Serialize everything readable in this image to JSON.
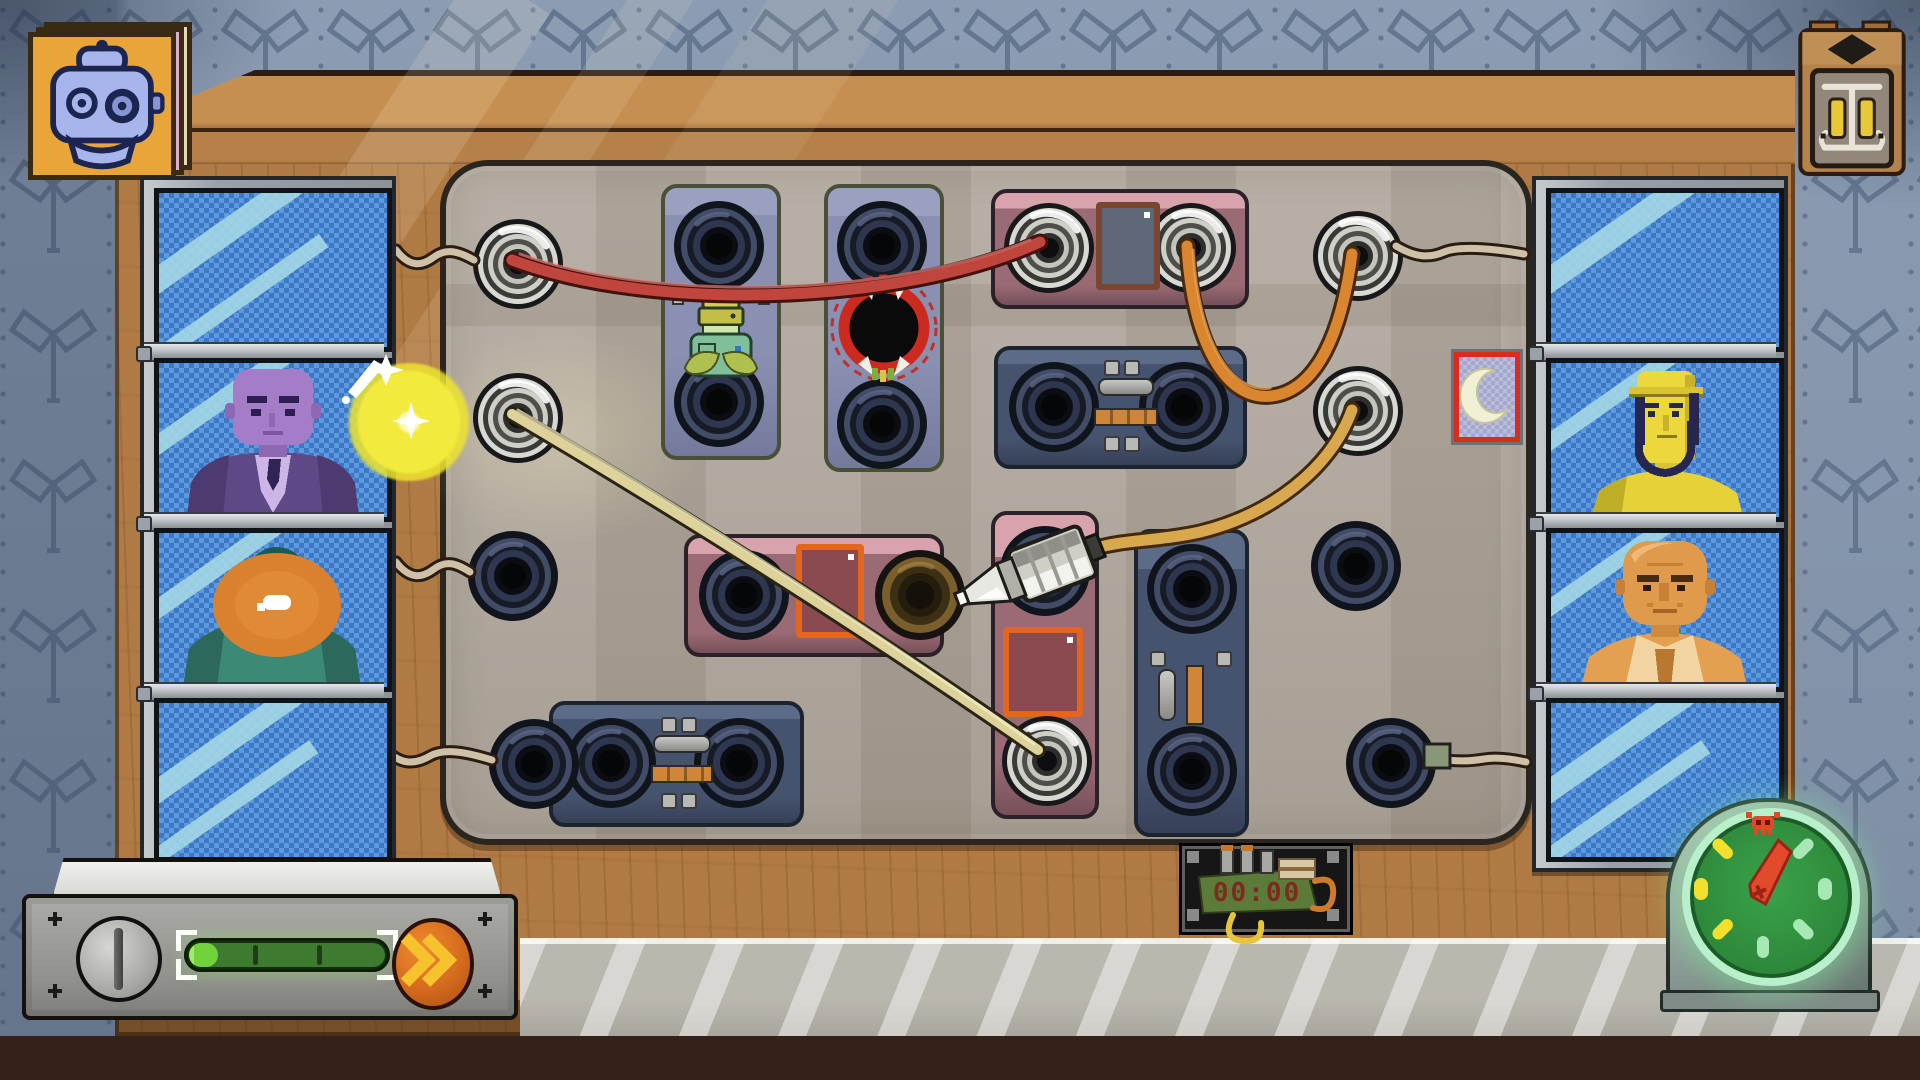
{
  "scene": "pixel-art telephone switchboard operator game",
  "bomb_timer": {
    "display": "00:00"
  },
  "console": {
    "progress_percent": 15,
    "segments": 3,
    "button": "fast-forward"
  },
  "doom_clock": {
    "needle_deg": 22,
    "marker": "skull-at-12"
  },
  "callers": {
    "left": [
      {
        "state": "empty-static"
      },
      {
        "state": "on-call",
        "who": "purple-suited-man",
        "fx": "sparkle"
      },
      {
        "state": "on-call",
        "who": "teal-hooded-person",
        "fx": "speaking-orange-glow",
        "icon": "handset"
      },
      {
        "state": "empty-static"
      }
    ],
    "right": [
      {
        "state": "empty-static"
      },
      {
        "state": "on-call",
        "who": "yellow-bearded-man-in-hat"
      },
      {
        "state": "on-call",
        "who": "orange-bald-man"
      },
      {
        "state": "empty-static"
      }
    ]
  },
  "jacks": {
    "left": [
      "plugged",
      "plugged",
      "empty",
      "empty"
    ],
    "right": [
      "plugged",
      "plugged",
      "empty",
      "empty"
    ],
    "modules": {
      "a_top": "empty",
      "a_bottom": "empty",
      "b_top": "empty",
      "b_bottom": "empty",
      "c_left": "plugged",
      "c_right": "plugged",
      "d_left": "empty",
      "d_right": "empty",
      "e_left": "empty",
      "e_right": "stained",
      "f_top": "empty",
      "f_bottom": "plugged",
      "g_top": "empty",
      "g_bottom": "empty",
      "h_left": "empty",
      "h_right": "empty"
    }
  },
  "cables": [
    {
      "id": "red",
      "from": "left-jack-1",
      "to": "module-c-left-jack"
    },
    {
      "id": "orange",
      "from": "module-c-right-jack",
      "to": "right-jack-1"
    },
    {
      "id": "amber",
      "from": "right-jack-2",
      "to": "loose-plug"
    },
    {
      "id": "khaki",
      "from": "left-jack-2",
      "to": "module-f-bottom-jack"
    }
  ],
  "indicator_tile": {
    "icon": "crescent",
    "border": "red"
  },
  "decor": {
    "picture": "robot-portrait",
    "wall_device": "bell-box"
  },
  "colors": {
    "wall": "#8c9cb2",
    "wood": "#b07a44",
    "woodLight": "#c68f52",
    "panel": "#b3aba1",
    "cableRed": "#c0453c",
    "cableOrange": "#d9862f",
    "cableAmber": "#d8a84e",
    "cableKhaki": "#ded29b",
    "glow": "#ece42e",
    "screenBlue": "#4a8ed6",
    "accentOrange": "#e07820",
    "barGreen": "#72d23c",
    "clockMint": "#b8f0cc",
    "alertRed": "#d93a2a"
  }
}
